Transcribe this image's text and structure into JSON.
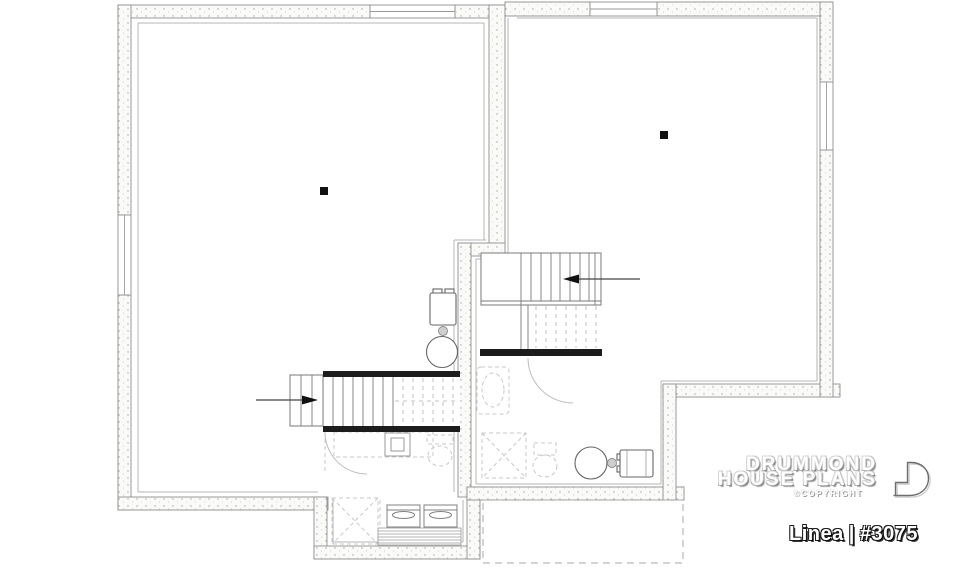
{
  "branding": {
    "line1": "DRUMMOND",
    "line2": "HOUSE PLANS",
    "copyright": "©COPYRIGHT",
    "logo_icon": "drummond-d-monogram-icon"
  },
  "plan_title": {
    "name": "Linea",
    "separator": "|",
    "number": "#3075"
  },
  "drawing": {
    "type": "basement-floor-plan",
    "fixtures": [
      "foundation-wall-stippled",
      "window-opening",
      "support-post",
      "staircase-upper-flight",
      "staircase-lower-flight",
      "stair-direction-arrow",
      "furnace",
      "water-heater",
      "washer",
      "dryer",
      "laundry-tub",
      "future-bathroom-dashed",
      "shower-dashed",
      "toilet-dashed",
      "sink-dashed",
      "door-swing-arc",
      "unexcavated-area-dashed"
    ]
  },
  "colors": {
    "background": "#ffffff",
    "wall_fill": "#fafaf8",
    "wall_stipple": "#a8a49e",
    "wall_line": "#8f8f8f",
    "furring_line": "#b4b4b4",
    "stair_line": "#7a7a7a",
    "dashed_fixture": "#c8c8c8",
    "solid_black": "#1c1c1c",
    "logo_text": "#ffffff",
    "plan_label_text": "#ffffff"
  }
}
